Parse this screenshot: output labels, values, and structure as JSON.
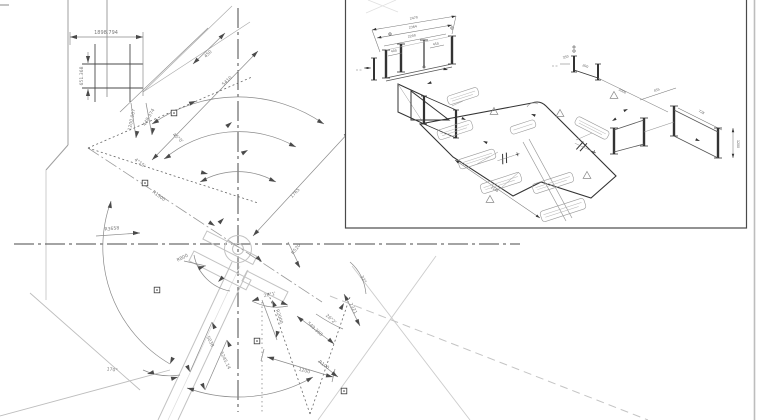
{
  "palette": {
    "background": "#ffffff",
    "line_dark": "#3a3a3a",
    "line_medium": "#8a8a8a",
    "line_light": "#c8c8c8",
    "dim_text": "#7a7a7a",
    "sheet_edge": "#bdbdbd"
  },
  "plan": {
    "dim_width": "1898.794",
    "dim_height": "651.368",
    "dim_450": "450",
    "dim_5410": "5410",
    "dim_1200_007": "1200.007",
    "dim_448_374": "448.374",
    "ang_45": "45°0'",
    "ang_4_15": "4°15'",
    "rad_1500": "R1500",
    "rad_3658": "R3658",
    "dim_1765": "1765",
    "rad_520": "R520",
    "rad_800": "R800",
    "ang_170": "170°",
    "dim_5038": "5038",
    "dim_5245": "5245.14",
    "ang_26_1": "26°1'",
    "rad_2000": "R2000",
    "dim_549": "549.368",
    "ang_26_2": "26°2'",
    "dim_1200": "1200",
    "rad_100": "R100",
    "ang_32": "32°",
    "dim_2321": "2321"
  },
  "iso": {
    "dim_2470": "2470",
    "dim_2364": "2364",
    "dim_2200": "2200",
    "dim_400": "400",
    "dim_450": "450",
    "dim_2000": "2000",
    "dim_1148": "1148",
    "dim_1200": "1200",
    "dim_455": "455",
    "dim_728": "728",
    "dim_350": "350",
    "dim_200": "200"
  }
}
